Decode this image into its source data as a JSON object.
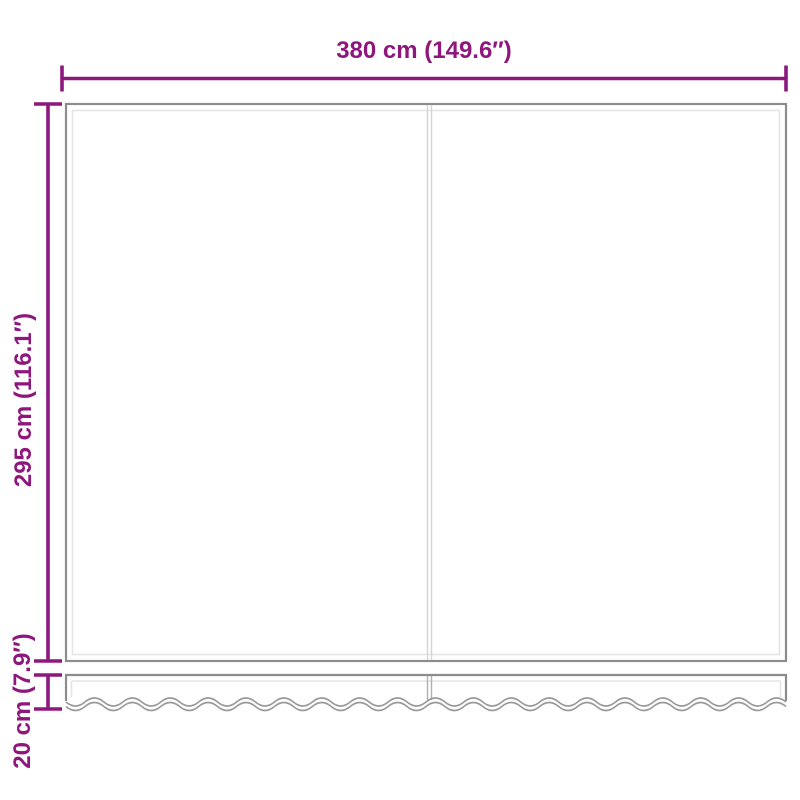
{
  "labels": {
    "width": "380 cm (149.6″)",
    "height": "295 cm (116.1″)",
    "valance_height": "20 cm (7.9″)"
  },
  "colors": {
    "dimension": "#8e177d",
    "outline": "#8c8c8c",
    "inner_line": "#e4e4e4",
    "panel_divider": "#d4d4d4",
    "valance_divider": "#b0b0b0",
    "wave": "#9a9a9a",
    "background": "#ffffff"
  }
}
